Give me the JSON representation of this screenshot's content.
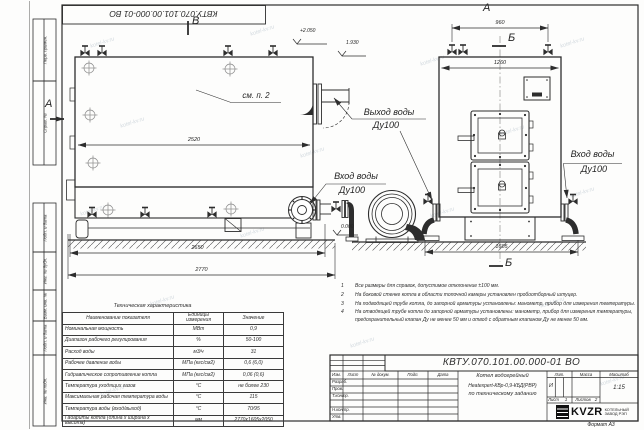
{
  "corner_stamp": {
    "number": "КВТУ.070.101.00.000-01 ВО"
  },
  "margin_labels": {
    "perv_primen": "Перв. примен.",
    "sprav_no": "Справ. №",
    "podp_data_1": "Подп. и дата",
    "inv_dubl": "Инв. № дубл.",
    "vzam_inv": "Взам. инв. №",
    "podp_data_2": "Подп. и дата",
    "inv_podl": "Инв. № подл."
  },
  "drawing": {
    "section_marks": {
      "v": "В",
      "a_left": "А",
      "a_top": "А",
      "b_top": "Б",
      "b_bottom": "Б"
    },
    "see_item": "см. п. 2",
    "elevations": {
      "top_left": "+2.050",
      "top_right": "1.930",
      "ground": "0.000"
    },
    "dimensions": {
      "side_width": "2520",
      "side_base": "2650",
      "side_overall": "2770",
      "front_valves": "960",
      "front_width": "1260",
      "front_overall": "1605"
    },
    "labels": {
      "water_outlet_line1": "Выход воды",
      "water_outlet_line2": "Ду100",
      "water_inlet_side_line1": "Вход воды",
      "water_inlet_side_line2": "Ду100",
      "water_inlet_front_line1": "Вход воды",
      "water_inlet_front_line2": "Ду100"
    }
  },
  "spec_table": {
    "title": "Техническая характеристика",
    "headers": [
      "Наименование показателя",
      "Единицы измерения",
      "Значение"
    ],
    "rows": [
      [
        "Номинальная мощность",
        "МВт",
        "0,9"
      ],
      [
        "Диапазон рабочего регулирования",
        "%",
        "50-100"
      ],
      [
        "Расход воды",
        "м3/ч",
        "31"
      ],
      [
        "Рабочее давление воды",
        "МПа (кгс/см2)",
        "0,6 (6,0)"
      ],
      [
        "Гидравлическое сопротивление котла",
        "МПа (кгс/см2)",
        "0,06 (0,6)"
      ],
      [
        "Температура уходящих газов",
        "°С",
        "не более 230"
      ],
      [
        "Максимальная рабочая температура воды",
        "°С",
        "115"
      ],
      [
        "Температура воды (вход/выход)",
        "°С",
        "70/95"
      ],
      [
        "Габариты котла (длина х ширина х высота)",
        "мм",
        "2770х1605х2050"
      ]
    ]
  },
  "notes": {
    "items": [
      {
        "num": "1",
        "text": "Все размеры для справок, допустимое отклонение ±100 мм."
      },
      {
        "num": "2",
        "text": "На боковой стенке котла в области топочной камеры установлен пробоотборный штуцер."
      },
      {
        "num": "3",
        "text": "На подводящей трубе котла, до запорной арматуры установлены: манометр, прибор для измерения температуры."
      },
      {
        "num": "4",
        "text": "На отводящей трубе котла до запорной арматуры установлены: манометр, прибор для измерения температуры, предохранительный клапан Ду не менее 50 мм и отвод с обратным клапаном Ду не менее 50 мм."
      }
    ]
  },
  "title_block": {
    "number": "КВТУ.070.101.00.000-01 ВО",
    "name_line1": "Котел водогрейный",
    "name_line2": "Heatexpert-КВр-0,9-КБД(РВР)",
    "name_line3": "по техническому заданию",
    "headers": {
      "izm": "Изм.",
      "list": "Лист",
      "doc": "№ докум.",
      "podp": "Подп.",
      "data": "Дата",
      "lit": "Лит.",
      "massa": "Масса",
      "masshtab": "Масштаб"
    },
    "rows": {
      "razrab": "Разраб.",
      "prov": "Пров.",
      "tkontr": "Т.контр.",
      "nkontr": "Н.контр.",
      "utv": "Утв."
    },
    "lit_value": "И",
    "scale": "1:15",
    "list_label": "Лист",
    "list_value": "1",
    "listov_label": "Листов",
    "listov_value": "2",
    "company": {
      "logo": "KVZR",
      "caption_line1": "КОТЕЛЬНЫЙ",
      "caption_line2": "ЗАВОД РЭП"
    },
    "format": "Формат А3"
  },
  "watermark": {
    "text": "kotel-kv.ru"
  }
}
